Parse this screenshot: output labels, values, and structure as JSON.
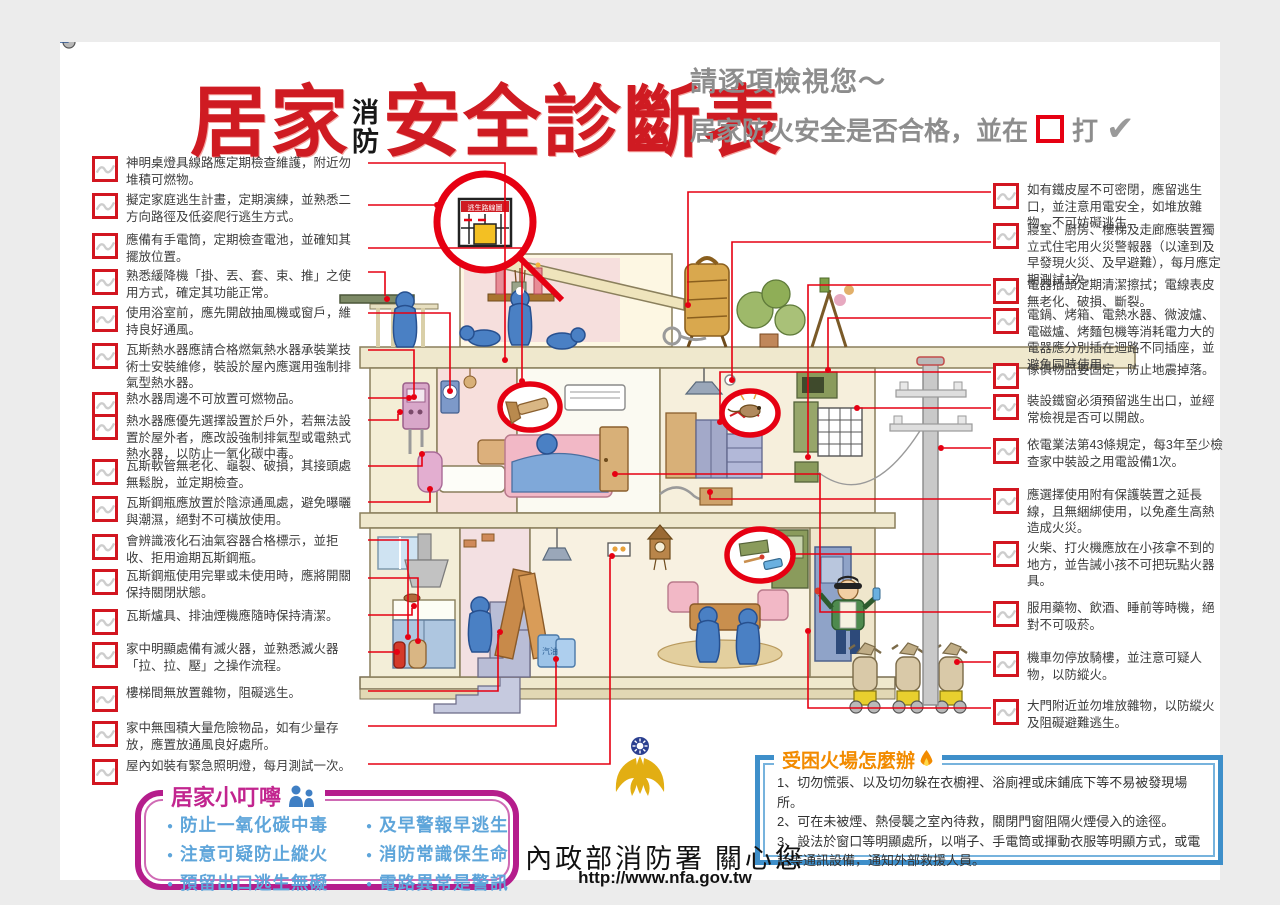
{
  "header": {
    "title_part1": "居家",
    "title_small_stacked": [
      "消",
      "防"
    ],
    "title_part2": "安全診斷表",
    "subtitle_line1": "請逐項檢視您～",
    "subtitle_line2_prefix": "居家防火安全是否合格，並在",
    "subtitle_line2_suffix": "打",
    "check_glyph": "✔"
  },
  "checklist_left": [
    {
      "text": "神明桌燈具線路應定期檢查維護，附近勿堆積可燃物。"
    },
    {
      "text": "擬定家庭逃生計畫，定期演練，並熟悉二方向路徑及低姿爬行逃生方式。"
    },
    {
      "text": "應備有手電筒，定期檢查電池，並確知其擺放位置。"
    },
    {
      "text": "熟悉緩降機「掛、丟、套、束、推」之使用方式，確定其功能正常。"
    },
    {
      "text": "使用浴室前，應先開啟抽風機或窗戶，維持良好通風。"
    },
    {
      "text": "瓦斯熱水器應請合格燃氣熱水器承裝業技術士安裝維修，裝設於屋內應選用強制排氣型熱水器。"
    },
    {
      "text": "熱水器周邊不可放置可燃物品。"
    },
    {
      "text": "熱水器應優先選擇設置於戶外，若無法設置於屋外者，應改設強制排氣型或電熱式熱水器，以防止一氧化碳中毒。"
    },
    {
      "text": "瓦斯軟管無老化、龜裂、破損，其接頭處無鬆脫，並定期檢查。"
    },
    {
      "text": "瓦斯鋼瓶應放置於陰涼通風處，避免曝曬與潮濕，絕對不可橫放使用。"
    },
    {
      "text": "會辨識液化石油氣容器合格標示，並拒收、拒用逾期瓦斯鋼瓶。"
    },
    {
      "text": "瓦斯鋼瓶使用完畢或未使用時，應將開關保持關閉狀態。"
    },
    {
      "text": "瓦斯爐具、排油煙機應隨時保持清潔。"
    },
    {
      "text": "家中明顯處備有滅火器，並熟悉滅火器「拉、拉、壓」之操作流程。"
    },
    {
      "text": "樓梯間無放置雜物，阻礙逃生。"
    },
    {
      "text": "家中無囤積大量危險物品，如有少量存放，應置放通風良好處所。"
    },
    {
      "text": "屋內如裝有緊急照明燈，每月測試一次。"
    }
  ],
  "checklist_right": [
    {
      "text": "如有鐵皮屋不可密閉，應留逃生口，並注意用電安全，如堆放雜物，不可妨礙逃生。"
    },
    {
      "text": "寢室、廚房、樓梯及走廊應裝置獨立式住宅用火災警報器（以達到及早發現火災、及早避難），每月應定期測試1次。"
    },
    {
      "text": "電器插頭定期清潔擦拭；電線表皮無老化、破損、斷裂。"
    },
    {
      "text": "電鍋、烤箱、電熱水器、微波爐、電磁爐、烤麵包機等消耗電力大的電器應分別插在迴路不同插座，並避免同時使用。"
    },
    {
      "text": "傢俱物品要固定，防止地震掉落。"
    },
    {
      "text": "裝設鐵窗必須預留逃生出口，並經常檢視是否可以開啟。"
    },
    {
      "text": "依電業法第43條規定，每3年至少檢查家中裝設之用電設備1次。"
    },
    {
      "text": "應選擇使用附有保護裝置之延長線，且無綑綁使用，以免產生高熱造成火災。"
    },
    {
      "text": "火柴、打火機應放在小孩拿不到的地方，並告誡小孩不可把玩點火器具。"
    },
    {
      "text": "服用藥物、飲酒、睡前等時機，絕對不可吸菸。"
    },
    {
      "text": "機車勿停放騎樓，並注意可疑人物，以防縱火。"
    },
    {
      "text": "大門附近並勿堆放雜物，以防縱火及阻礙避難逃生。"
    }
  ],
  "illustration": {
    "escape_sign_label": "逃生路線圖",
    "gasoline_label": "汽油"
  },
  "tips_box": {
    "title": "居家小叮嚀",
    "items_col1": [
      "防止一氧化碳中毒",
      "注意可疑防止縱火",
      "預留出口逃生無礙"
    ],
    "items_col2": [
      "及早警報早逃生",
      "消防常識保生命",
      "電路異常是警訊"
    ]
  },
  "rescue_box": {
    "title": "受困火場怎麼辦",
    "items": [
      "1、切勿慌張、以及切勿躲在衣櫥裡、浴廁裡或床鋪底下等不易被發現場所。",
      "2、可在未被煙、熱侵襲之室內待救，關閉門窗阻隔火煙侵入的途徑。",
      "3、設法於窗口等明顯處所，以哨子、手電筒或揮動衣服等明顯方式，或電話等通訊設備，通知外部救援人員。"
    ]
  },
  "footer": {
    "agency": "內政部消防署 關心您",
    "url": "http://www.nfa.gov.tw"
  },
  "colors": {
    "accent_red": "#e60012",
    "checkbox_red": "#d21620",
    "title_red": "#cf1b22",
    "subtitle_gray": "#8d8d8d",
    "tips_purple": "#b51d8c",
    "tips_blue_text": "#5ea5da",
    "rescue_blue": "#3e8fca",
    "rescue_orange": "#f28b00",
    "emblem_gold": "#e2ae13",
    "figure_blue": "#4a80c4",
    "background_gray": "#ececec"
  }
}
